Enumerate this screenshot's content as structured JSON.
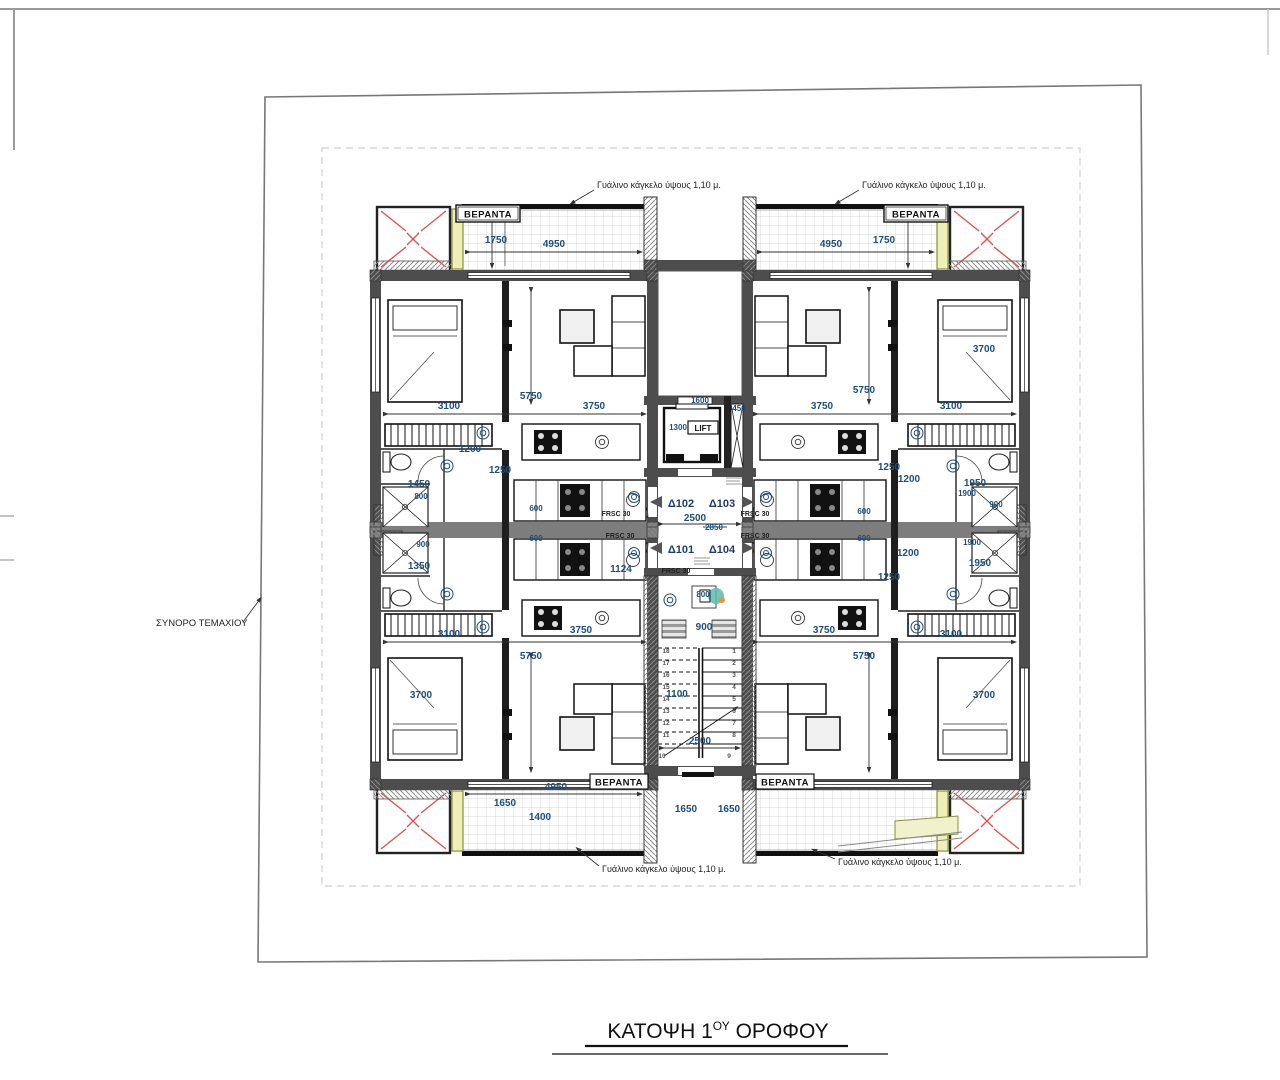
{
  "title": {
    "main": "ΚΑΤΟΨΗ 1",
    "sup": "ΟΥ",
    "rest": " ΟΡΟΦΟΥ"
  },
  "labels": {
    "veranda": "ΒΕΡΑΝΤΑ",
    "boundary": "ΣΥΝΟΡΟ ΤΕΜΑΧΙΟΥ",
    "railing": "Γυάλινο κάγκελο ύψους 1,10 μ.",
    "lift": "LIFT",
    "fire_rating": "FRSC 30"
  },
  "apartments": {
    "a1": "Δ101",
    "a2": "Δ102",
    "a3": "Δ103",
    "a4": "Δ104"
  },
  "colors": {
    "dim_text": "#1d4e7a",
    "wall": "#4d4d4d",
    "party_wall": "#7d7d7d",
    "red_x": "#e05252",
    "yellow_strip": "#eef0b6",
    "teal_figure": "#5bbcae",
    "balcony_grid": "#c9c9c9"
  },
  "svg_texts": [
    {
      "t": "1750",
      "x": 496,
      "y": 243,
      "c": "d"
    },
    {
      "t": "4950",
      "x": 554,
      "y": 247,
      "c": "d"
    },
    {
      "t": "4950",
      "x": 831,
      "y": 247,
      "c": "d"
    },
    {
      "t": "1750",
      "x": 884,
      "y": 243,
      "c": "d"
    },
    {
      "t": "3100",
      "x": 449,
      "y": 409,
      "c": "d"
    },
    {
      "t": "5750",
      "x": 531,
      "y": 399,
      "c": "d"
    },
    {
      "t": "3750",
      "x": 594,
      "y": 409,
      "c": "d"
    },
    {
      "t": "3750",
      "x": 822,
      "y": 409,
      "c": "d"
    },
    {
      "t": "5750",
      "x": 864,
      "y": 393,
      "c": "d"
    },
    {
      "t": "3100",
      "x": 951,
      "y": 409,
      "c": "d"
    },
    {
      "t": "3700",
      "x": 984,
      "y": 352,
      "c": "d"
    },
    {
      "t": "1200",
      "x": 470,
      "y": 452,
      "c": "d"
    },
    {
      "t": "1250",
      "x": 500,
      "y": 473,
      "c": "d"
    },
    {
      "t": "1450",
      "x": 419,
      "y": 487,
      "c": "d"
    },
    {
      "t": "800",
      "x": 421,
      "y": 499,
      "c": "d2"
    },
    {
      "t": "900",
      "x": 423,
      "y": 547,
      "c": "d2"
    },
    {
      "t": "1350",
      "x": 419,
      "y": 569,
      "c": "d"
    },
    {
      "t": "1250",
      "x": 889,
      "y": 470,
      "c": "d"
    },
    {
      "t": "1200",
      "x": 909,
      "y": 482,
      "c": "d"
    },
    {
      "t": "1950",
      "x": 975,
      "y": 486,
      "c": "d"
    },
    {
      "t": "1900",
      "x": 967,
      "y": 496,
      "c": "d2"
    },
    {
      "t": "900",
      "x": 996,
      "y": 507,
      "c": "d2"
    },
    {
      "t": "1900",
      "x": 972,
      "y": 545,
      "c": "d2"
    },
    {
      "t": "1950",
      "x": 980,
      "y": 566,
      "c": "d"
    },
    {
      "t": "1200",
      "x": 908,
      "y": 556,
      "c": "d"
    },
    {
      "t": "1250",
      "x": 889,
      "y": 580,
      "c": "d"
    },
    {
      "t": "2500",
      "x": 695,
      "y": 521,
      "c": "d"
    },
    {
      "t": "2850",
      "x": 714,
      "y": 530,
      "c": "d2"
    },
    {
      "t": "1124",
      "x": 621,
      "y": 572,
      "c": "d"
    },
    {
      "t": "1600",
      "x": 700,
      "y": 403,
      "c": "d2"
    },
    {
      "t": "1300",
      "x": 678,
      "y": 430,
      "c": "d2"
    },
    {
      "t": "450",
      "x": 739,
      "y": 411,
      "c": "d2"
    },
    {
      "t": "800",
      "x": 703,
      "y": 597,
      "c": "d2"
    },
    {
      "t": "900",
      "x": 704,
      "y": 630,
      "c": "d"
    },
    {
      "t": "1100",
      "x": 677,
      "y": 697,
      "c": "d"
    },
    {
      "t": "2500",
      "x": 700,
      "y": 744,
      "c": "d"
    },
    {
      "t": "3100",
      "x": 449,
      "y": 637,
      "c": "d"
    },
    {
      "t": "5750",
      "x": 531,
      "y": 659,
      "c": "d"
    },
    {
      "t": "3750",
      "x": 581,
      "y": 633,
      "c": "d"
    },
    {
      "t": "3750",
      "x": 824,
      "y": 633,
      "c": "d"
    },
    {
      "t": "5750",
      "x": 864,
      "y": 659,
      "c": "d"
    },
    {
      "t": "3100",
      "x": 951,
      "y": 637,
      "c": "d"
    },
    {
      "t": "3700",
      "x": 421,
      "y": 698,
      "c": "d"
    },
    {
      "t": "3700",
      "x": 984,
      "y": 698,
      "c": "d"
    },
    {
      "t": "600",
      "x": 536,
      "y": 511,
      "c": "d2"
    },
    {
      "t": "600",
      "x": 536,
      "y": 541,
      "c": "d2"
    },
    {
      "t": "600",
      "x": 864,
      "y": 514,
      "c": "d2"
    },
    {
      "t": "600",
      "x": 864,
      "y": 541,
      "c": "d2"
    },
    {
      "t": "4950",
      "x": 556,
      "y": 790,
      "c": "d"
    },
    {
      "t": "1650",
      "x": 505,
      "y": 806,
      "c": "d"
    },
    {
      "t": "1400",
      "x": 540,
      "y": 820,
      "c": "d"
    },
    {
      "t": "1650",
      "x": 686,
      "y": 812,
      "c": "d"
    },
    {
      "t": "1650",
      "x": 729,
      "y": 812,
      "c": "d"
    },
    {
      "t": "FRSC 30",
      "x": 616,
      "y": 516,
      "c": "frsc"
    },
    {
      "t": "FRSC 30",
      "x": 620,
      "y": 538,
      "c": "frsc"
    },
    {
      "t": "FRSC 30",
      "x": 755,
      "y": 516,
      "c": "frsc"
    },
    {
      "t": "FRSC 30",
      "x": 755,
      "y": 538,
      "c": "frsc"
    },
    {
      "t": "FRSC 30",
      "x": 676,
      "y": 573,
      "c": "frsc"
    },
    {
      "t": "1",
      "x": 734,
      "y": 653,
      "c": "tiny"
    },
    {
      "t": "2",
      "x": 734,
      "y": 665,
      "c": "tiny"
    },
    {
      "t": "3",
      "x": 734,
      "y": 677,
      "c": "tiny"
    },
    {
      "t": "4",
      "x": 734,
      "y": 689,
      "c": "tiny"
    },
    {
      "t": "5",
      "x": 734,
      "y": 701,
      "c": "tiny"
    },
    {
      "t": "6",
      "x": 734,
      "y": 713,
      "c": "tiny"
    },
    {
      "t": "7",
      "x": 734,
      "y": 725,
      "c": "tiny"
    },
    {
      "t": "8",
      "x": 734,
      "y": 737,
      "c": "tiny"
    },
    {
      "t": "9",
      "x": 729,
      "y": 758,
      "c": "tiny"
    },
    {
      "t": "18",
      "x": 666,
      "y": 653,
      "c": "tiny"
    },
    {
      "t": "17",
      "x": 666,
      "y": 665,
      "c": "tiny"
    },
    {
      "t": "16",
      "x": 666,
      "y": 677,
      "c": "tiny"
    },
    {
      "t": "15",
      "x": 666,
      "y": 689,
      "c": "tiny"
    },
    {
      "t": "14",
      "x": 666,
      "y": 701,
      "c": "tiny"
    },
    {
      "t": "13",
      "x": 666,
      "y": 713,
      "c": "tiny"
    },
    {
      "t": "12",
      "x": 666,
      "y": 725,
      "c": "tiny"
    },
    {
      "t": "11",
      "x": 666,
      "y": 737,
      "c": "tiny"
    },
    {
      "t": "10",
      "x": 662,
      "y": 758,
      "c": "tiny"
    }
  ]
}
